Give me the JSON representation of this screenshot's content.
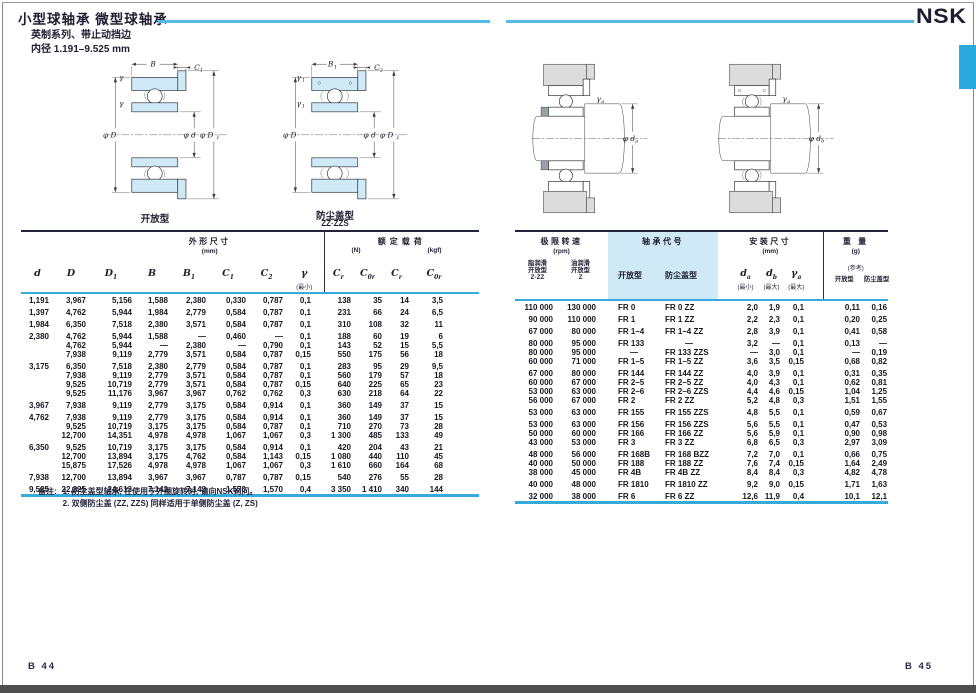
{
  "page": {
    "title": "小型球轴承  微型球轴承",
    "subtitle": "英制系列、带止动挡边",
    "bore": "内径  1.191–9.525 mm",
    "brand": "NSK",
    "page_left": "B 44",
    "page_right": "B 45"
  },
  "diagrams": {
    "open": {
      "caption": "开放型",
      "b": "B",
      "c1_main": "C",
      "c1_sub": "1",
      "g1": "γ",
      "g2": "γ",
      "pd": "φ D",
      "pdb": "φ d",
      "pd1_main": "φ D",
      "pd1_sub": "1"
    },
    "shielded": {
      "caption": "防尘盖型",
      "caption_sub": "ZZ·ZZS",
      "b_main": "B",
      "b_sub": "1",
      "c_main": "C",
      "c_sub": "2",
      "g_main": "γ",
      "g_sub": "1",
      "pd": "φ D",
      "pdb": "φ d",
      "pd1_main": "φ D",
      "pd1_sub": "1"
    },
    "mount_open": {
      "gamma_main": "γ",
      "gamma_sub": "a",
      "phi_main": "φ d",
      "phi_sub": "a"
    },
    "mount_shielded": {
      "gamma_main": "γ",
      "gamma_sub": "a",
      "phi_main": "φ d",
      "phi_sub": "b"
    }
  },
  "left_table": {
    "header": {
      "dims_title": "外形尺寸",
      "dims_unit": "(mm)",
      "load_title": "额定载荷",
      "load_unit_n": "(N)",
      "load_unit_kgf": "(kgf)",
      "sym_d": "d",
      "sym_D": "D",
      "sym_D1": "D|1",
      "sym_B": "B",
      "sym_B1": "B|1",
      "sym_C1": "C|1",
      "sym_C2": "C|2",
      "sym_gamma": "γ",
      "gamma_note": "(最小)",
      "sym_cr": "C|r",
      "sym_c0r": "C|0r",
      "sym_cr2": "C|r",
      "sym_c0r2": "C|0r"
    },
    "groups": [
      {
        "rows": [
          [
            "1,191",
            "3,967",
            "5,156",
            "1,588",
            "2,380",
            "0,330",
            "0,787",
            "0,1",
            "138",
            "35",
            "14",
            "3,5"
          ]
        ]
      },
      {
        "rows": [
          [
            "1,397",
            "4,762",
            "5,944",
            "1,984",
            "2,779",
            "0,584",
            "0,787",
            "0,1",
            "231",
            "66",
            "24",
            "6,5"
          ]
        ]
      },
      {
        "rows": [
          [
            "1,984",
            "6,350",
            "7,518",
            "2,380",
            "3,571",
            "0,584",
            "0,787",
            "0,1",
            "310",
            "108",
            "32",
            "11"
          ]
        ]
      },
      {
        "rows": [
          [
            "2,380",
            "4,762",
            "5,944",
            "1,588",
            "—",
            "0,460",
            "—",
            "0,1",
            "188",
            "60",
            "19",
            "6"
          ],
          [
            "",
            "4,762",
            "5,944",
            "—",
            "2,380",
            "—",
            "0,790",
            "0,1",
            "143",
            "52",
            "15",
            "5,5"
          ],
          [
            "",
            "7,938",
            "9,119",
            "2,779",
            "3,571",
            "0,584",
            "0,787",
            "0,15",
            "550",
            "175",
            "56",
            "18"
          ]
        ]
      },
      {
        "rows": [
          [
            "3,175",
            "6,350",
            "7,518",
            "2,380",
            "2,779",
            "0,584",
            "0,787",
            "0,1",
            "283",
            "95",
            "29",
            "9,5"
          ],
          [
            "",
            "7,938",
            "9,119",
            "2,779",
            "3,571",
            "0,584",
            "0,787",
            "0,1",
            "560",
            "179",
            "57",
            "18"
          ],
          [
            "",
            "9,525",
            "10,719",
            "2,779",
            "3,571",
            "0,584",
            "0,787",
            "0,15",
            "640",
            "225",
            "65",
            "23"
          ],
          [
            "",
            "9,525",
            "11,176",
            "3,967",
            "3,967",
            "0,762",
            "0,762",
            "0,3",
            "630",
            "218",
            "64",
            "22"
          ]
        ]
      },
      {
        "rows": [
          [
            "3,967",
            "7,938",
            "9,119",
            "2,779",
            "3,175",
            "0,584",
            "0,914",
            "0,1",
            "360",
            "149",
            "37",
            "15"
          ]
        ]
      },
      {
        "rows": [
          [
            "4,762",
            "7,938",
            "9,119",
            "2,779",
            "3,175",
            "0,584",
            "0,914",
            "0,1",
            "360",
            "149",
            "37",
            "15"
          ],
          [
            "",
            "9,525",
            "10,719",
            "3,175",
            "3,175",
            "0,584",
            "0,787",
            "0,1",
            "710",
            "270",
            "73",
            "28"
          ],
          [
            "",
            "12,700",
            "14,351",
            "4,978",
            "4,978",
            "1,067",
            "1,067",
            "0,3",
            "1 300",
            "485",
            "133",
            "49"
          ]
        ]
      },
      {
        "rows": [
          [
            "6,350",
            "9,525",
            "10,719",
            "3,175",
            "3,175",
            "0,584",
            "0,914",
            "0,1",
            "420",
            "204",
            "43",
            "21"
          ],
          [
            "",
            "12,700",
            "13,894",
            "3,175",
            "4,762",
            "0,584",
            "1,143",
            "0,15",
            "1 080",
            "440",
            "110",
            "45"
          ],
          [
            "",
            "15,875",
            "17,526",
            "4,978",
            "4,978",
            "1,067",
            "1,067",
            "0,3",
            "1 610",
            "660",
            "164",
            "68"
          ]
        ]
      },
      {
        "rows": [
          [
            "7,938",
            "12,700",
            "13,894",
            "3,967",
            "3,967",
            "0,787",
            "0,787",
            "0,15",
            "540",
            "276",
            "55",
            "28"
          ]
        ]
      },
      {
        "rows": [
          [
            "9,525",
            "22,225",
            "24,613",
            "7,142",
            "7,142",
            "1,570",
            "1,570",
            "0,4",
            "3 350",
            "1 410",
            "340",
            "144"
          ]
        ]
      }
    ]
  },
  "right_table": {
    "header": {
      "speed_title": "极限转速",
      "speed_unit": "(rpm)",
      "grease_l1": "脂润滑",
      "grease_l2": "开放型",
      "grease_l3": "Z·ZZ",
      "oil_l1": "油润滑",
      "oil_l2": "开放型",
      "oil_l3": "Z",
      "code_title": "轴承代号",
      "code_open": "开放型",
      "code_shield": "防尘盖型",
      "mount_title": "安装尺寸",
      "mount_unit": "(mm)",
      "sym_da": "d|a",
      "da_note": "(最小)",
      "sym_db": "d|b",
      "db_note": "(最大)",
      "sym_ga": "γ|a",
      "ga_note": "(最大)",
      "weight_title": "重 量",
      "weight_unit": "(g)",
      "weight_ref": "(参考)",
      "weight_open": "开放型",
      "weight_shield": "防尘盖型"
    },
    "groups": [
      {
        "rows": [
          [
            "110 000",
            "130 000",
            "FR 0",
            "FR 0 ZZ",
            "2,0",
            "1,9",
            "0,1",
            "0,11",
            "0,16"
          ]
        ]
      },
      {
        "rows": [
          [
            "90 000",
            "110 000",
            "FR 1",
            "FR 1 ZZ",
            "2,2",
            "2,3",
            "0,1",
            "0,20",
            "0,25"
          ]
        ]
      },
      {
        "rows": [
          [
            "67 000",
            "80 000",
            "FR 1–4",
            "FR 1–4 ZZ",
            "2,8",
            "3,9",
            "0,1",
            "0,41",
            "0,58"
          ]
        ]
      },
      {
        "rows": [
          [
            "80 000",
            "95 000",
            "FR 133",
            "—",
            "3,2",
            "—",
            "0,1",
            "0,13",
            "—"
          ],
          [
            "80 000",
            "95 000",
            "—",
            "FR 133 ZZS",
            "—",
            "3,0",
            "0,1",
            "—",
            "0,19"
          ],
          [
            "60 000",
            "71 000",
            "FR 1–5",
            "FR 1–5 ZZ",
            "3,6",
            "3,5",
            "0,15",
            "0,68",
            "0,82"
          ]
        ]
      },
      {
        "rows": [
          [
            "67 000",
            "80 000",
            "FR 144",
            "FR 144 ZZ",
            "4,0",
            "3,9",
            "0,1",
            "0,31",
            "0,35"
          ],
          [
            "60 000",
            "67 000",
            "FR 2–5",
            "FR 2–5 ZZ",
            "4,0",
            "4,3",
            "0,1",
            "0,62",
            "0,81"
          ],
          [
            "53 000",
            "63 000",
            "FR 2–6",
            "FR 2–6 ZZS",
            "4,4",
            "4,6",
            "0,15",
            "1,04",
            "1,25"
          ],
          [
            "56 000",
            "67 000",
            "FR 2",
            "FR 2 ZZ",
            "5,2",
            "4,8",
            "0,3",
            "1,51",
            "1,55"
          ]
        ]
      },
      {
        "rows": [
          [
            "53 000",
            "63 000",
            "FR 155",
            "FR 155 ZZS",
            "4,8",
            "5,5",
            "0,1",
            "0,59",
            "0,67"
          ]
        ]
      },
      {
        "rows": [
          [
            "53 000",
            "63 000",
            "FR 156",
            "FR 156 ZZS",
            "5,6",
            "5,5",
            "0,1",
            "0,47",
            "0,53"
          ],
          [
            "50 000",
            "60 000",
            "FR 166",
            "FR 166 ZZ",
            "5,6",
            "5,9",
            "0,1",
            "0,90",
            "0,98"
          ],
          [
            "43 000",
            "53 000",
            "FR 3",
            "FR 3 ZZ",
            "6,8",
            "6,5",
            "0,3",
            "2,97",
            "3,09"
          ]
        ]
      },
      {
        "rows": [
          [
            "48 000",
            "56 000",
            "FR 168B",
            "FR 168 BZZ",
            "7,2",
            "7,0",
            "0,1",
            "0,66",
            "0,75"
          ],
          [
            "40 000",
            "50 000",
            "FR 188",
            "FR 188 ZZ",
            "7,6",
            "7,4",
            "0,15",
            "1,64",
            "2,49"
          ],
          [
            "38 000",
            "45 000",
            "FR 4B",
            "FR 4B ZZ",
            "8,4",
            "8,4",
            "0,3",
            "4,82",
            "4,78"
          ]
        ]
      },
      {
        "rows": [
          [
            "40 000",
            "48 000",
            "FR 1810",
            "FR 1810 ZZ",
            "9,2",
            "9,0",
            "0,15",
            "1,71",
            "1,63"
          ]
        ]
      },
      {
        "rows": [
          [
            "32 000",
            "38 000",
            "FR 6",
            "FR 6 ZZ",
            "12,6",
            "11,9",
            "0,4",
            "10,1",
            "12,1"
          ]
        ]
      }
    ]
  },
  "notes": {
    "label": "备注:",
    "item1": "1.  防尘盖型轴承, 在使用于外圈旋转时, 请向NSK询问。",
    "item2": "2.  双侧防尘盖 (ZZ, ZZS) 同样适用于单侧防尘盖 (Z, ZS)"
  },
  "colors": {
    "accent_blue": "#3cb4e5",
    "light_blue_fill": "#cfe9f6",
    "dark_rule": "#23233c",
    "text": "#1d1d30",
    "bottom_bar": "#4f4f4f"
  }
}
